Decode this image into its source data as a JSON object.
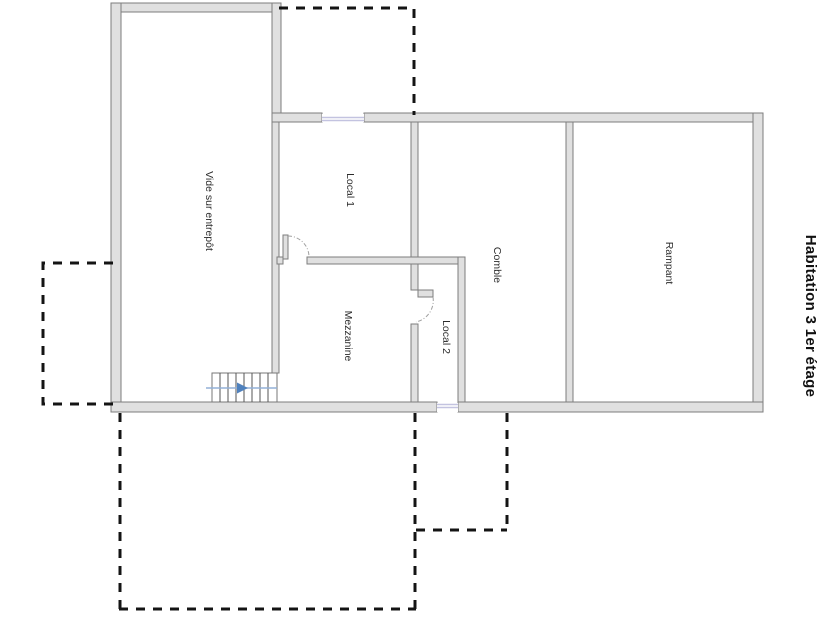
{
  "plan_title": "Habitation 3 1er étage",
  "rooms": {
    "vide_sur_entrepot": "Vide sur entrepôt",
    "local_1": "Local 1",
    "mezzanine": "Mezzanine",
    "local_2": "Local 2",
    "comble": "Comble",
    "rampant": "Rampant"
  },
  "icons": {
    "stairs_direction": "right-arrow"
  },
  "colors": {
    "wall-fill": "#e0e0e0",
    "wall-stroke": "#7d7d7d",
    "window-line": "#c3c3e0",
    "dashed-outline": "#141414",
    "stair-line": "#555555",
    "stair-guide": "#93b1d7",
    "stair-arrow": "#4f81bd",
    "door-arc": "#a0a0a0",
    "label-text": "#2b2b2b",
    "title-text": "#111111"
  }
}
